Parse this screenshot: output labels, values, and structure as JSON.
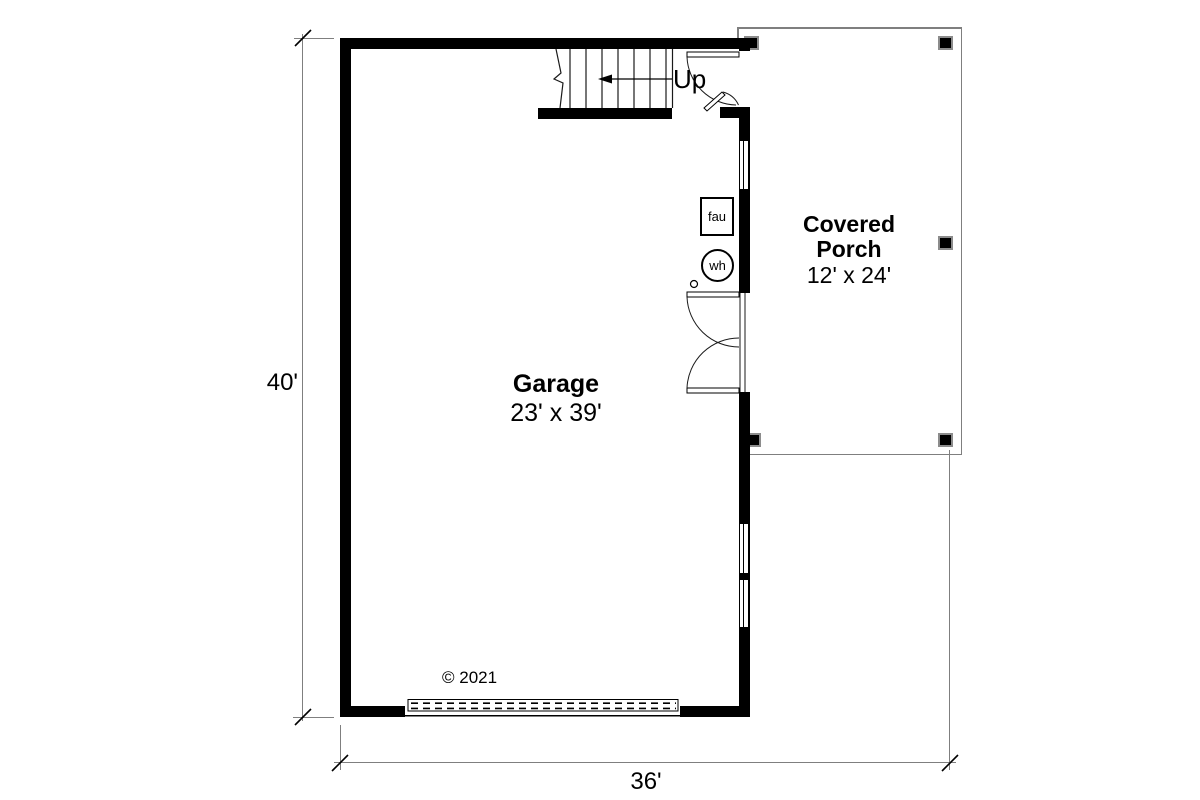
{
  "plan": {
    "rooms": [
      {
        "id": "garage",
        "name": "Garage",
        "dimensions": "23' x 39'"
      },
      {
        "id": "covered-porch",
        "name_lines": [
          "Covered",
          "Porch"
        ],
        "dimensions": "12' x 24'"
      }
    ],
    "stair": {
      "up_label": "Up"
    },
    "equipment": [
      {
        "id": "fau",
        "label": "fau"
      },
      {
        "id": "wh",
        "label": "wh"
      }
    ],
    "dimensions": {
      "left": "40'",
      "bottom": "36'"
    },
    "copyright": "© 2021",
    "colors": {
      "wall": "#000000",
      "porch_outline": "#7f7f7f",
      "dimension_line": "#7f7f7f",
      "background": "#ffffff",
      "text": "#000000"
    }
  }
}
